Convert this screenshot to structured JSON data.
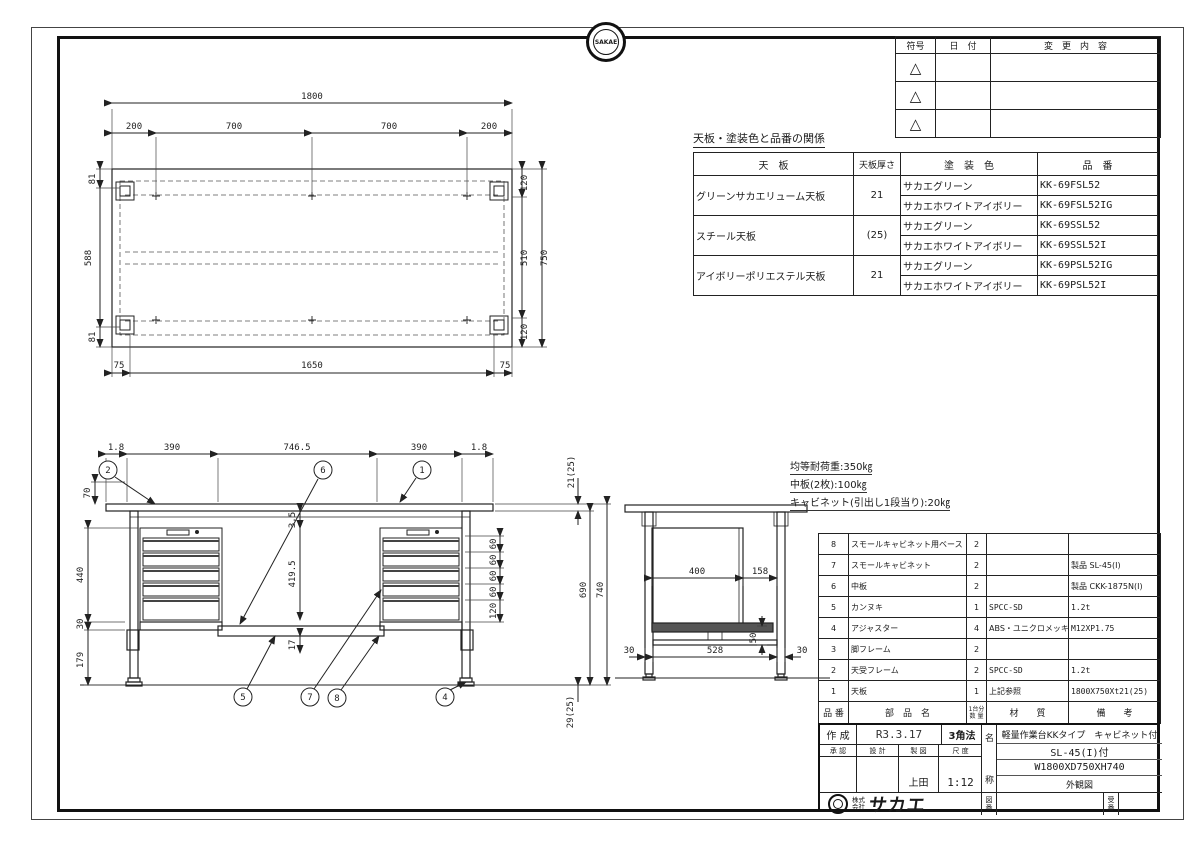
{
  "stamp": {
    "text": "SAKAE"
  },
  "revision": {
    "col_sign": "符号",
    "col_date": "日　付",
    "col_change": "変　更　内　容",
    "triangle": "△"
  },
  "coating": {
    "title": "天板・塗装色と品番の関係",
    "col_top": "天　板",
    "col_thickness": "天板厚さ",
    "col_color": "塗　装　色",
    "col_part": "品　番",
    "groups": [
      {
        "top": "グリーンサカエリューム天板",
        "thickness": "21",
        "rows": [
          {
            "color": "サカエグリーン",
            "part": "KK-69FSL52"
          },
          {
            "color": "サカエホワイトアイボリー",
            "part": "KK-69FSL52IG"
          }
        ]
      },
      {
        "top": "スチール天板",
        "thickness": "(25)",
        "rows": [
          {
            "color": "サカエグリーン",
            "part": "KK-69SSL52"
          },
          {
            "color": "サカエホワイトアイボリー",
            "part": "KK-69SSL52I"
          }
        ]
      },
      {
        "top": "アイボリーポリエステル天板",
        "thickness": "21",
        "rows": [
          {
            "color": "サカエグリーン",
            "part": "KK-69PSL52IG"
          },
          {
            "color": "サカエホワイトアイボリー",
            "part": "KK-69PSL52I"
          }
        ]
      }
    ]
  },
  "tv": {
    "total_w": "1800",
    "seg1": "200",
    "seg2": "700",
    "seg3": "700",
    "seg4": "200",
    "left_top": "81",
    "left_mid": "588",
    "left_bot": "81",
    "right_top": "120",
    "right_mid": "510",
    "right_bot": "120",
    "overall_d": "750",
    "bot_left": "75",
    "bot_mid": "1650",
    "bot_right": "75"
  },
  "fv": {
    "t1": "1.8",
    "t2": "390",
    "t3": "746.5",
    "t4": "390",
    "t5": "1.8",
    "left1": "70",
    "left2": "440",
    "left3": "30",
    "left4": "179",
    "mid1": "3.5",
    "mid2": "419.5",
    "mid3": "17",
    "d1": "60",
    "d2": "60",
    "d3": "60",
    "d4": "60",
    "d5": "120",
    "r1": "21(25)",
    "r2": "690",
    "r3": "740",
    "r4": "29(25)",
    "balloons": {
      "b1": "1",
      "b2": "2",
      "b4": "4",
      "b5": "5",
      "b6": "6",
      "b7": "7",
      "b8": "8"
    }
  },
  "sv": {
    "w1": "400",
    "w2": "158",
    "h1": "50",
    "b1": "30",
    "b2": "528",
    "b3": "30"
  },
  "notes": {
    "n1": "均等耐荷重:350㎏",
    "n2": "中板(2枚):100㎏",
    "n3": "キャビネット(引出し1段当り):20㎏"
  },
  "parts": {
    "col_no": "品 番",
    "col_name": "部　品　名",
    "col_qty_1": "1台分",
    "col_qty_2": "数 量",
    "col_material": "材　　質",
    "col_remark": "備　　考",
    "rows": [
      {
        "no": "8",
        "name": "スモールキャビネット用ベース",
        "qty": "2",
        "material": "",
        "remark": ""
      },
      {
        "no": "7",
        "name": "スモールキャビネット",
        "qty": "2",
        "material": "",
        "remark": "製品 SL-45(I)"
      },
      {
        "no": "6",
        "name": "中板",
        "qty": "2",
        "material": "",
        "remark": "製品 CKK-1875N(I)"
      },
      {
        "no": "5",
        "name": "カンヌキ",
        "qty": "1",
        "material": "SPCC-SD",
        "remark": "1.2t"
      },
      {
        "no": "4",
        "name": "アジャスター",
        "qty": "4",
        "material": "ABS・ユニクロメッキ",
        "remark": "M12XP1.75"
      },
      {
        "no": "3",
        "name": "脚フレーム",
        "qty": "2",
        "material": "",
        "remark": ""
      },
      {
        "no": "2",
        "name": "天受フレーム",
        "qty": "2",
        "material": "SPCC-SD",
        "remark": "1.2t"
      },
      {
        "no": "1",
        "name": "天板",
        "qty": "1",
        "material": "上記参照",
        "remark": "1800X750Xt21(25)"
      }
    ]
  },
  "tb": {
    "created_label": "作 成",
    "created_value": "R3.3.17",
    "projection": "3角法",
    "approve": "承 認",
    "design": "設 計",
    "draft": "製 図",
    "scale_label": "尺 度",
    "drafter": "上田",
    "scale": "1:12",
    "name_l1": "名",
    "name_l2": "称",
    "name_line1": "軽量作業台KKタイプ　キャビネット付",
    "name_line2": "SL-45(I)付",
    "name_line3": "W1800XD750XH740",
    "name_line4": "外観図",
    "company_p1": "株式",
    "company_p2": "会社",
    "company": "サカエ",
    "zuban_1": "図",
    "zuban_2": "番",
    "ukeban_1": "受",
    "ukeban_2": "番"
  }
}
